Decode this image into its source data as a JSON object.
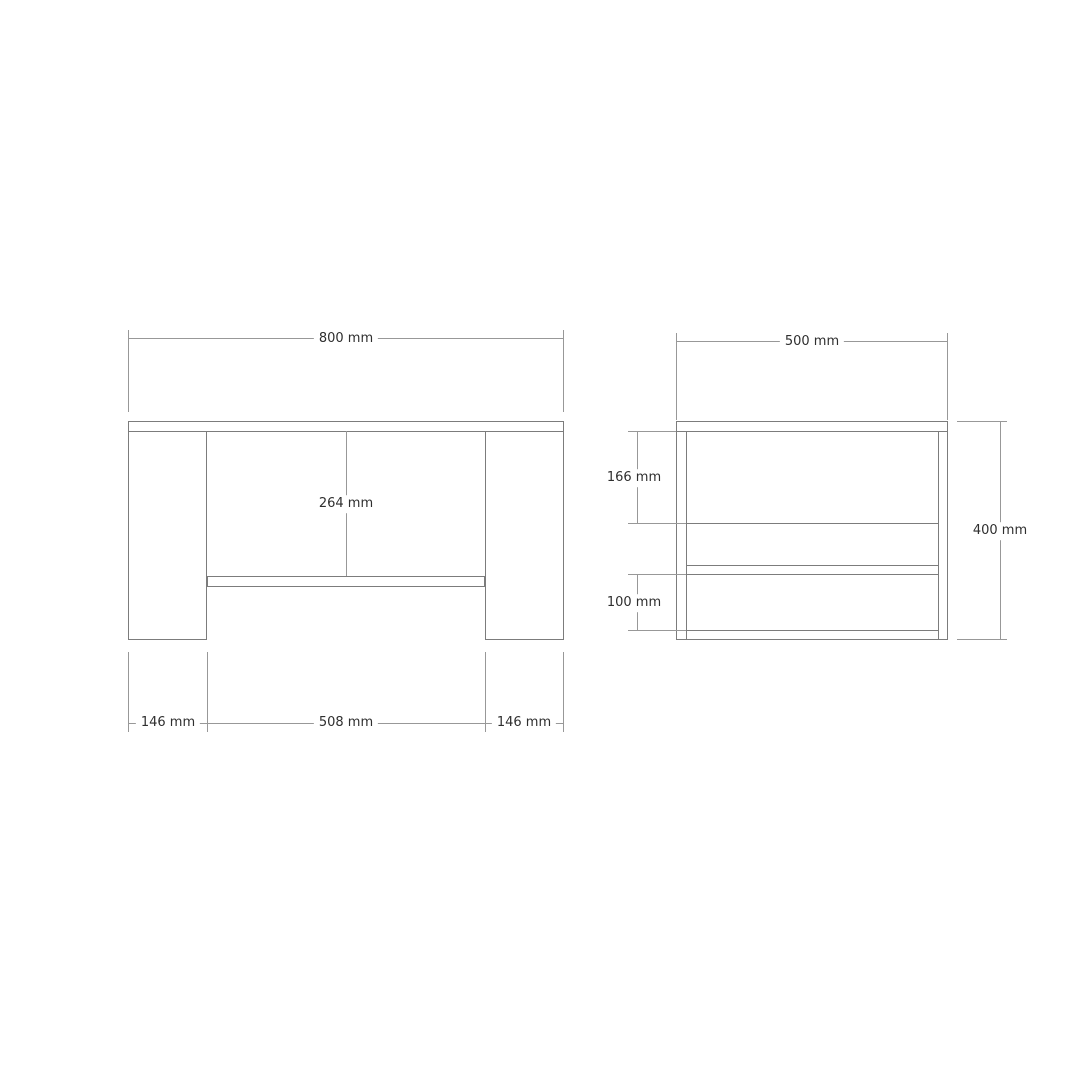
{
  "colors": {
    "object_line": "#7c7c7c",
    "dimension_line": "#989898",
    "label_text": "#2f2f2f",
    "background": "#ffffff"
  },
  "front_view": {
    "dim_width": "800 mm",
    "dim_opening_height": "264 mm",
    "dim_left_foot": "146 mm",
    "dim_inner_span": "508 mm",
    "dim_right_foot": "146 mm"
  },
  "side_view": {
    "dim_depth": "500 mm",
    "dim_upper_opening": "166 mm",
    "dim_lower_opening": "100 mm",
    "dim_height": "400 mm"
  }
}
